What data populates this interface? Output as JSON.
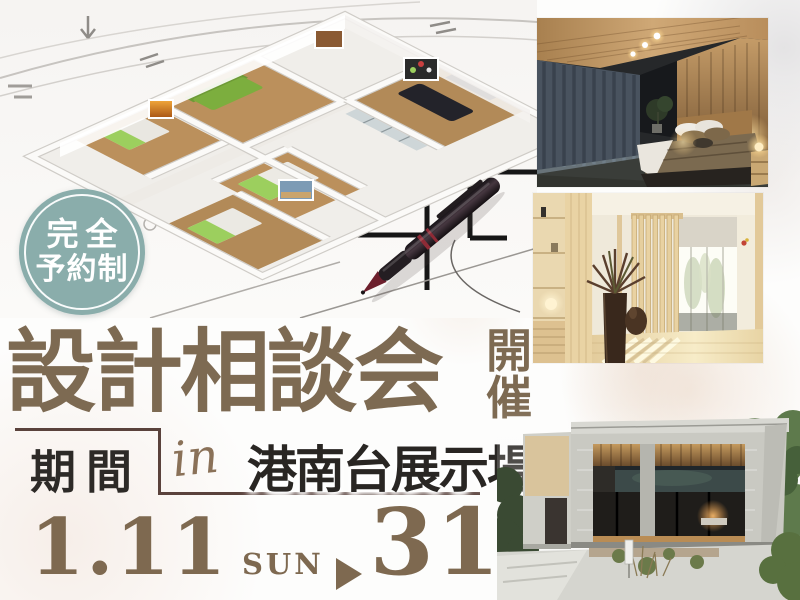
{
  "badge": {
    "line1": "完全",
    "line2": "予約制"
  },
  "title": {
    "main": "設計相談会",
    "suffix_chars": [
      "開",
      "催"
    ]
  },
  "period": {
    "label": "期間",
    "in_word": "in",
    "venue": "港南台展示場"
  },
  "dates": {
    "start": "1.11",
    "start_dow": "SUN",
    "arrow_icon": "right-triangle",
    "end": "31",
    "end_dow": "SAT"
  },
  "colors": {
    "badge_teal": "#8aadab",
    "title_brown": "#7d6a52",
    "date_brown": "#7e6950",
    "text_dark": "#2d2a27",
    "frame_brown": "#5a423c"
  },
  "images": {
    "floorplan": "3d-floorplan-on-blueprint-with-pen",
    "photo_top": "bedroom-photo",
    "photo_middle": "japanese-interior-photo",
    "photo_bottom": "house-exterior-photo"
  }
}
